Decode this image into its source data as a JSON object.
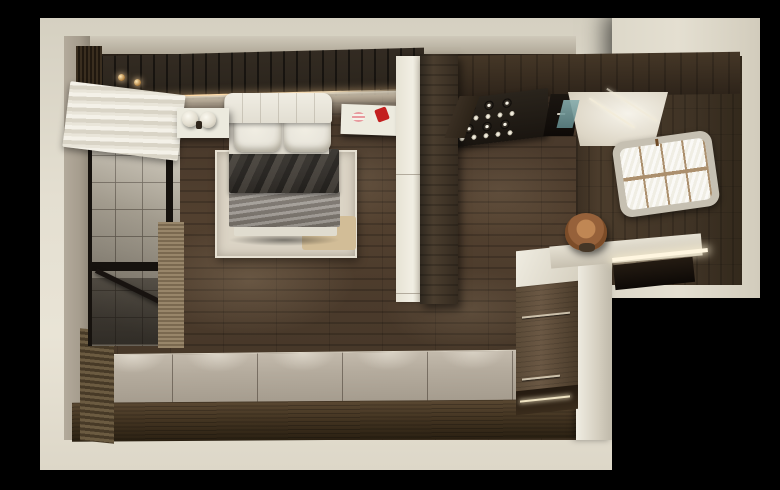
{
  "scene": {
    "type": "3d-interior-render",
    "view": "top-down floor plan perspective",
    "rooms": [
      "bedroom",
      "glazed balcony",
      "kitchen",
      "desk nook"
    ]
  },
  "labels": {
    "scene": "Top-down 3D render of a compact studio apartment on a black background",
    "footprint_main": "Main apartment volume with cream outer walls",
    "footprint_wing": "Kitchen and desk wing with cream outer walls",
    "bedroom_floor": "Dark wood plank bedroom floor",
    "platform": "Light grey plank platform along the lower wall",
    "slat_wall": "Dark wood slat accent wall with warm LED cove",
    "pendants": "Brass pendant lights",
    "balcony": "Black-framed glass partition with tiled balcony behind",
    "blind": "White roman blind",
    "bed": "Double bed with white headboard, pillows, charcoal duvet and grey throw",
    "rug": "Cream area rug",
    "nightstand": "White nightstand with twin sphere lamps",
    "shelf": "Floating shelf with red and striped decor",
    "closet": "White built-in closet front",
    "partition": "Dark wood wardrobe partition",
    "cabinets": "Dark wood upper kitchen cabinets",
    "rack": "Stemware rack with hanging glasses",
    "hood": "Black range hood",
    "glow": "Lit kitchen counter area",
    "window": "Rounded grid window in dark wood wall",
    "island": "Kitchen island with wood front and white top",
    "desk": "Built-in desk with LED task light and dark niche",
    "chair": "Tan leather desk chair"
  },
  "colors": {
    "bg": "#000000",
    "wall_cream": "#e4dfd1",
    "wall_taupe": "#a69d8e",
    "wood_floor": "#4a3a2b",
    "wood_slat": "#2a241c",
    "wood_cabinet": "#3f3325",
    "wood_partition": "#4a3d2e",
    "wood_island": "#6b5844",
    "plank_light": "#b4ab9d",
    "band_dark": "#443522",
    "led_warm": "#ffd9a4",
    "led_cool": "#fff6e0",
    "bed_linen": "#e9e6dc",
    "duvet": "#3f3b36",
    "blanket": "#8d8780",
    "rug": "#dbd4c5",
    "mat": "#d2bd97",
    "tile": "#cdc6b6",
    "frame_black": "#16120e",
    "chair": "#96613a",
    "accent_red": "#c32020",
    "accent_pink": "#e89a9e",
    "teal": "#5d8486",
    "pane": "#f4f2ea",
    "window_frame": "#c6c0b2",
    "muntin": "#ab8f6d",
    "glow_white": "#f6f3ea"
  }
}
